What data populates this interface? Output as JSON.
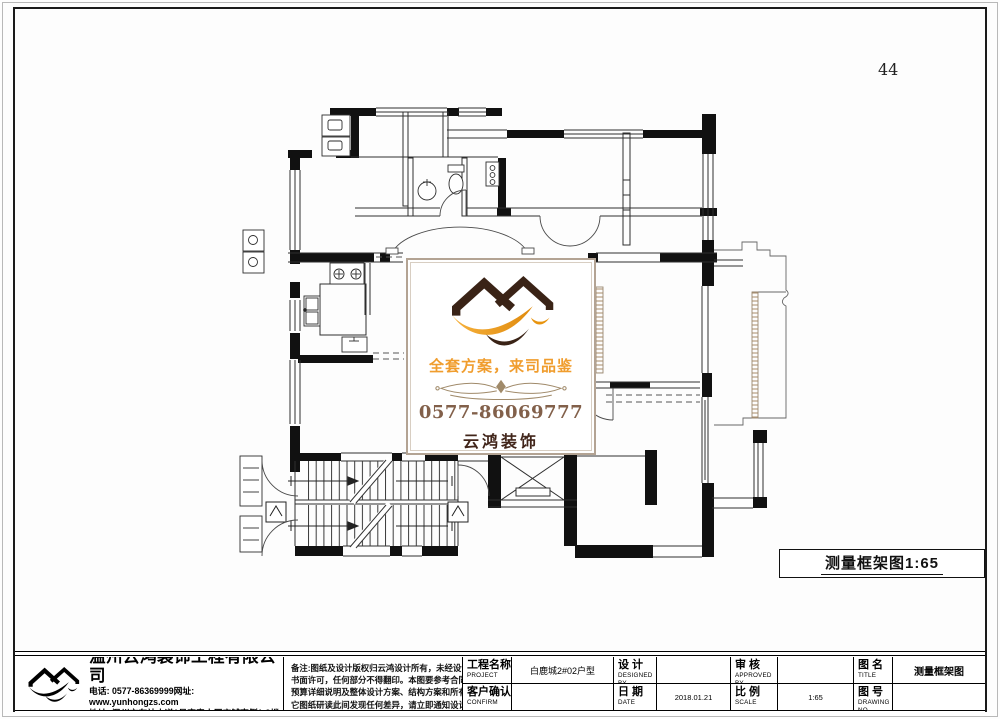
{
  "page": {
    "number": "44"
  },
  "colors": {
    "wall_black": "#111111",
    "accent_orange": "#f09d2e",
    "brand_brown": "#41251a",
    "phone_brown": "#82604a",
    "ornament_tan": "#a08a6a",
    "watermark_border": "#b3a393"
  },
  "watermark": {
    "slogan": "全套方案，来司品鉴",
    "phone": "0577-86069777",
    "brand": "云鸿装饰"
  },
  "plan_label": {
    "text": "测量框架图1:65"
  },
  "title_block": {
    "company": {
      "name": "温州云鸿装饰工程有限公司",
      "phone_line": "电话: 0577-86369999网址: www.yunhongzs.com",
      "address_line": "地址: 温州市车站大道1号宏泰大厦店铺南侧1-3楼"
    },
    "remarks": {
      "lines": [
        "备注:图纸及设计版权归云鸿设计所有，未经设计师",
        "书面许可，任何部分不得翻印。本图要参考合同、",
        "预算详细说明及整体设计方案、结构方案和所有其",
        "它图纸研读此间发现任何差异，请立即通知设计师。"
      ]
    },
    "fields": {
      "project_label": "工程名称",
      "project_sub": "PROJECT",
      "project_value": "白鹿城2#02户型",
      "design_label": "设 计",
      "design_sub": "DESIGNED BY",
      "design_value": "",
      "approve_label": "审 核",
      "approve_sub": "APPROVED BY",
      "approve_value": "",
      "title_label": "图 名",
      "title_sub": "TITLE",
      "title_value": "测量框架图",
      "confirm_label": "客户确认",
      "confirm_sub": "CONFIRM",
      "confirm_value": "",
      "date_label": "日 期",
      "date_sub": "DATE",
      "date_value": "2018.01.21",
      "scale_label": "比 例",
      "scale_sub": "SCALE",
      "scale_value": "1:65",
      "drawing_label": "图 号",
      "drawing_sub": "DRAWING NO",
      "drawing_value": ""
    }
  }
}
